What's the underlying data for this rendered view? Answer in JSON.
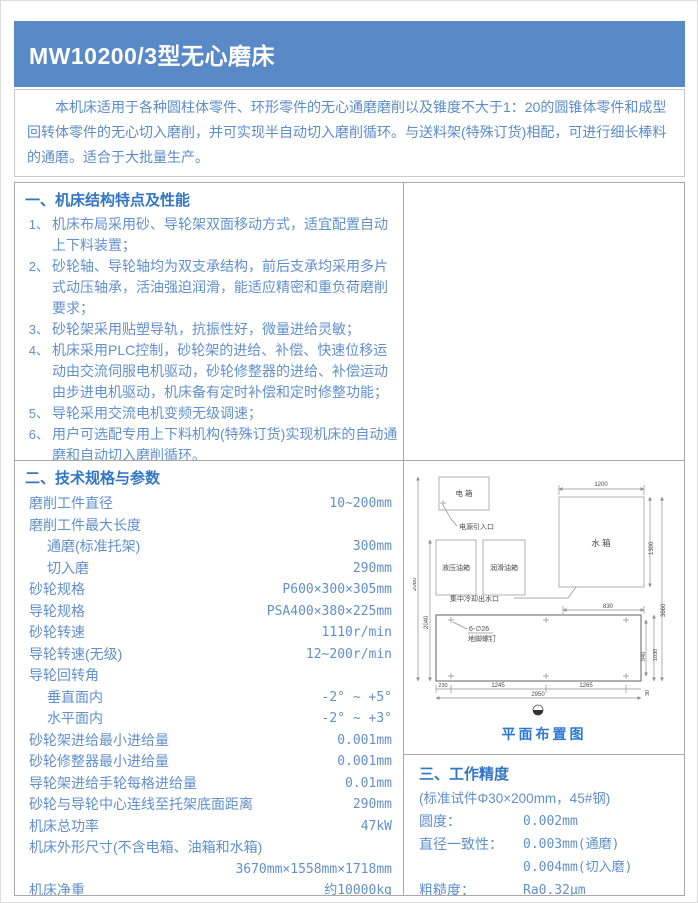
{
  "page": {
    "title": "MW10200/3型无心磨床"
  },
  "intro": {
    "text": "本机床适用于各种圆柱体零件、环形零件的无心通磨磨削以及锥度不大于1：20的圆锥体零件和成型回转体零件的无心切入磨削，并可实现半自动切入磨削循环。与送料架(特殊订货)相配，可进行细长棒料的通磨。适合于大批量生产。"
  },
  "section1": {
    "heading": "一、机床结构特点及性能",
    "items": [
      {
        "num": "1、",
        "text": "机床布局采用砂、导轮架双面移动方式，适宜配置自动上下料装置；"
      },
      {
        "num": "2、",
        "text": "砂轮轴、导轮轴均为双支承结构，前后支承均采用多片式动压轴承，活油强迫润滑，能适应精密和重负荷磨削要求；"
      },
      {
        "num": "3、",
        "text": "砂轮架采用贴塑导轨，抗振性好，微量进给灵敏；"
      },
      {
        "num": "4、",
        "text": "机床采用PLC控制，砂轮架的进给、补偿、快速位移运动由交流伺服电机驱动，砂轮修整器的进给、补偿运动由步进电机驱动，机床备有定时补偿和定时修整功能；"
      },
      {
        "num": "5、",
        "text": "导轮采用交流电机变频无级调速；"
      },
      {
        "num": "6、",
        "text": "用户可选配专用上下料机构(特殊订货)实现机床的自动通磨和自动切入磨削循环。"
      }
    ]
  },
  "section2": {
    "heading": "二、技术规格与参数",
    "rows": [
      {
        "label": "磨削工件直径",
        "value": "10~200mm"
      },
      {
        "label": "磨削工件最大长度",
        "value": ""
      },
      {
        "label": "通磨(标准托架)",
        "value": "300mm"
      },
      {
        "label": "切入磨",
        "value": "290mm"
      },
      {
        "label": "砂轮规格",
        "value": "P600×300×305mm"
      },
      {
        "label": "导轮规格",
        "value": "PSA400×380×225mm"
      },
      {
        "label": "砂轮转速",
        "value": "1110r/min"
      },
      {
        "label": "导轮转速(无级)",
        "value": "12~200r/min"
      },
      {
        "label": "导轮回转角",
        "value": ""
      },
      {
        "label": "垂直面内",
        "value": "-2° ~ +5°"
      },
      {
        "label": "水平面内",
        "value": "-2° ~ +3°"
      },
      {
        "label": "砂轮架进给最小进给量",
        "value": "0.001mm"
      },
      {
        "label": "砂轮修整器最小进给量",
        "value": "0.001mm"
      },
      {
        "label": "导轮架进给手轮每格进给量",
        "value": "0.01mm"
      },
      {
        "label": "砂轮与导轮中心连线至托架底面距离",
        "value": "290mm"
      },
      {
        "label": "机床总功率",
        "value": "47kW"
      },
      {
        "label": "机床外形尺寸(不含电箱、油箱和水箱)",
        "value": "3670mm×1558mm×1718mm"
      },
      {
        "label": "机床净重",
        "value": "约10000kg"
      }
    ]
  },
  "section3": {
    "heading": "三、工作精度",
    "note": "(标准试件Φ30×200mm，45#钢)",
    "rows": [
      {
        "label": "圆度：",
        "value": "0.002mm"
      },
      {
        "label": "直径一致性：",
        "value": "0.003mm(通磨)"
      },
      {
        "label": "",
        "value": "0.004mm(切入磨)"
      },
      {
        "label": "粗糙度：",
        "value": "Ra0.32μm"
      }
    ]
  },
  "diagram": {
    "caption": "平面布置图",
    "electric_box": "电 箱",
    "power_inlet": "电源引入口",
    "hydraulic_tank": "液压油箱",
    "lube_tank": "润滑油箱",
    "water_tank": "水 箱",
    "cooling_outlet": "集中冷却出水口",
    "anchor_bolt_line1": "6-∅26",
    "anchor_bolt_line2": "地脚螺钉",
    "dims": {
      "tank_top_width": "1200",
      "tank_height": "1300",
      "total_depth": "3660",
      "outlet_offset": "830",
      "left_total": "2080",
      "left_inner": "2040",
      "bolt_left": "230",
      "bolt_mid": "1245",
      "bolt_right": "1265",
      "machine_width": "2950",
      "machine_height": "940",
      "machine_height_outer": "1030",
      "bottom_offset": "30"
    }
  },
  "colors": {
    "header_bg": "#5a89c8",
    "header_text": "#ffffff",
    "body_text": "#6290cb",
    "heading_text": "#3376c3",
    "caption_text": "#2d7ad0",
    "table_border": "#a9a9a9",
    "intro_border": "#c9c9c9",
    "diagram_line": "#8f8f8f"
  }
}
